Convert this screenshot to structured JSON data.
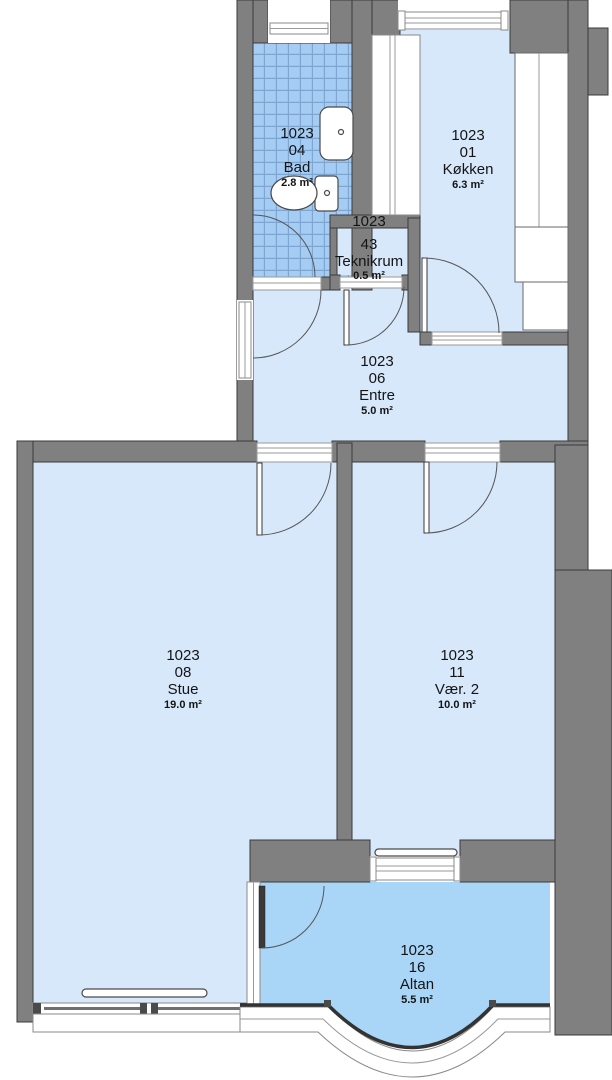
{
  "drawing": {
    "kind": "apartment floor plan",
    "unit_number": "1023"
  },
  "colors": {
    "wall": "#808080",
    "wall_outline": "#3a3a3a",
    "room_fill": "#d7e8fb",
    "balcony_fill": "#a9d6f7",
    "tile_fill": "#a5cdf3",
    "tile_grout": "#7fa6d1",
    "line": "#555555",
    "text": "#141414"
  },
  "rooms": [
    {
      "id": "1023",
      "sub": "04",
      "name": "Bad",
      "area": "2.8 m²"
    },
    {
      "id": "1023",
      "sub": "01",
      "name": "Køkken",
      "area": "6.3 m²"
    },
    {
      "id": "1023",
      "sub": "43",
      "name": "Teknikrum",
      "area": "0.5 m²"
    },
    {
      "id": "1023",
      "sub": "06",
      "name": "Entre",
      "area": "5.0 m²"
    },
    {
      "id": "1023",
      "sub": "08",
      "name": "Stue",
      "area": "19.0 m²"
    },
    {
      "id": "1023",
      "sub": "11",
      "name": "Vær. 2",
      "area": "10.0 m²"
    },
    {
      "id": "1023",
      "sub": "16",
      "name": "Altan",
      "area": "5.5 m²"
    }
  ]
}
